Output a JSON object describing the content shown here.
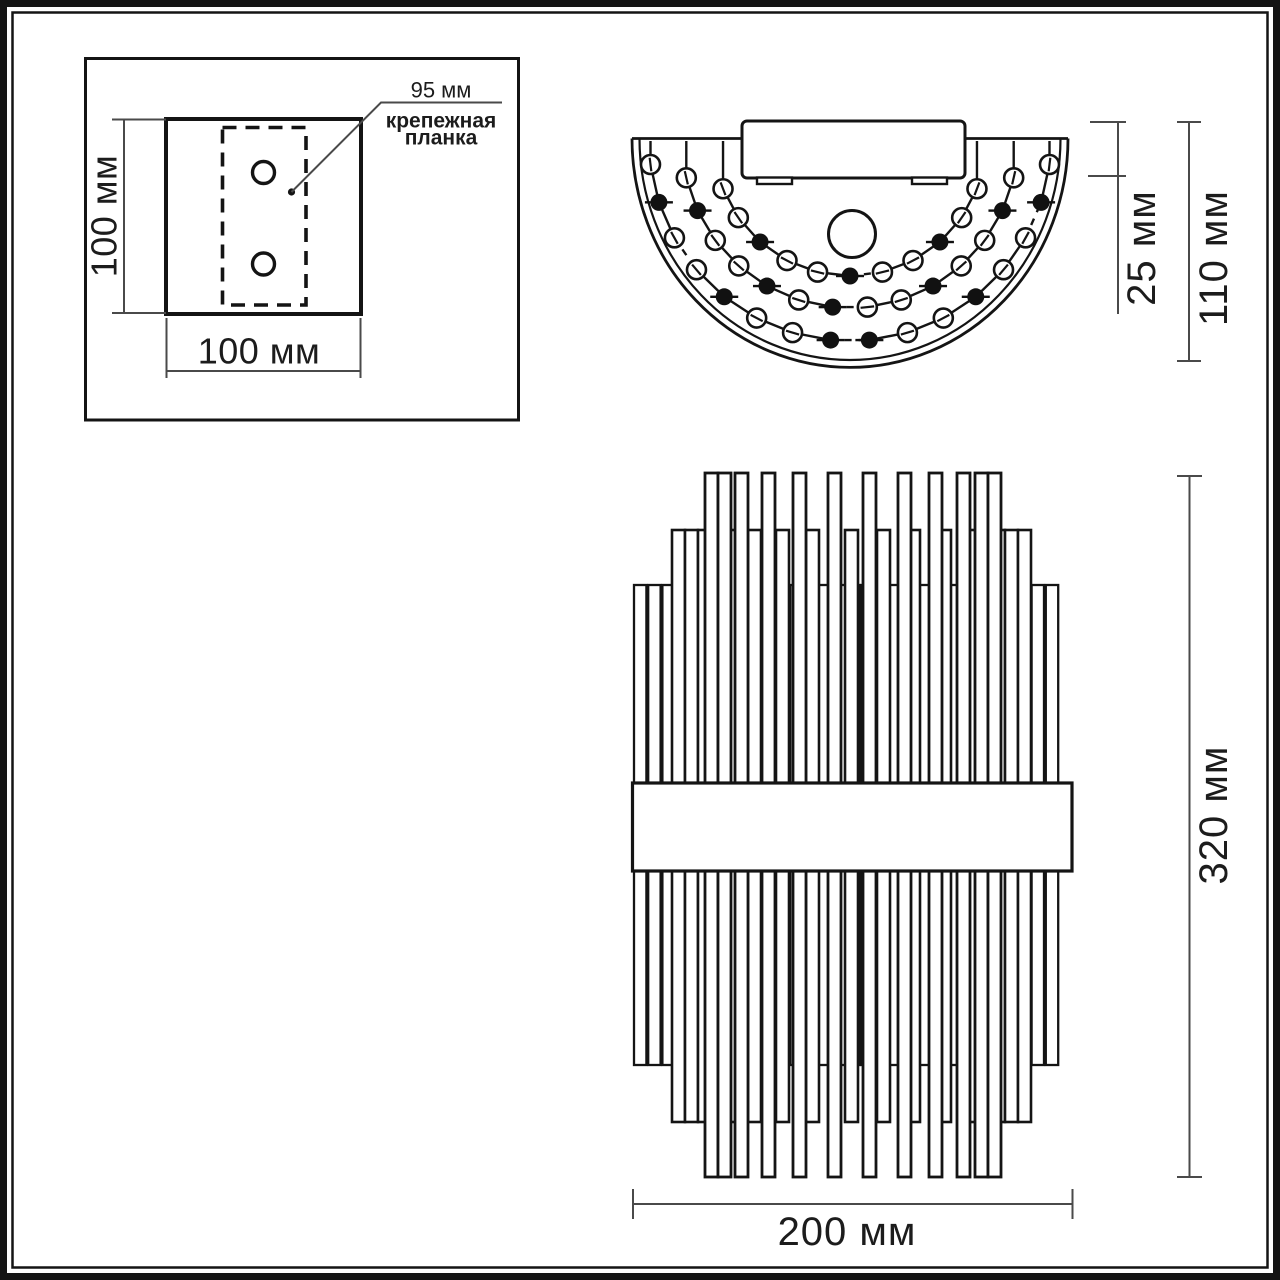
{
  "drawing_type": "wall-lamp dimension drawing",
  "colors": {
    "background": "#ffffff",
    "line": "#141414",
    "dimension_line": "#4a4a4a",
    "text": "#1c1c1c"
  },
  "labels": {
    "plate_height": "100 мм",
    "plate_width": "100 мм",
    "bar_width": "95 мм",
    "bar_note_line1": "крепежная",
    "bar_note_line2": "планка",
    "top_depth": "25 мм",
    "top_total_depth": "110 мм",
    "front_height": "320 мм",
    "front_width": "200 мм"
  },
  "geometry": {
    "top_view_chains": [
      {
        "r": 201,
        "a0": 187,
        "a1": 353,
        "n": 16,
        "black": [
          1,
          4,
          7,
          8,
          11,
          14
        ],
        "dash": [
          2,
          7,
          13
        ]
      },
      {
        "r": 168,
        "a0": 193,
        "a1": 347,
        "n": 14,
        "black": [
          1,
          4,
          6,
          9,
          12
        ],
        "dash": [
          6
        ]
      },
      {
        "r": 136,
        "a0": 201,
        "a1": 339,
        "n": 11,
        "black": [
          2,
          5,
          8
        ],
        "dash": [
          5
        ]
      }
    ],
    "front_rod_layers": [
      {
        "layer": "back",
        "top": 585,
        "bottom": 1065,
        "width": 12.4,
        "stroke": 2.3,
        "count": 30,
        "start": 634,
        "step": 14.2
      },
      {
        "layer": "mid",
        "top": 530,
        "bottom": 1122,
        "width": 13,
        "stroke": 2.6,
        "lefts": [
          672,
          685,
          698,
          727,
          748,
          776,
          806,
          845,
          877,
          907,
          938,
          963,
          992,
          1005,
          1018
        ]
      },
      {
        "layer": "front",
        "top": 473,
        "bottom": 1177,
        "width": 13,
        "stroke": 2.8,
        "lefts": [
          705,
          718,
          735,
          762,
          793,
          828,
          863,
          898,
          929,
          957,
          975,
          988
        ]
      }
    ]
  }
}
